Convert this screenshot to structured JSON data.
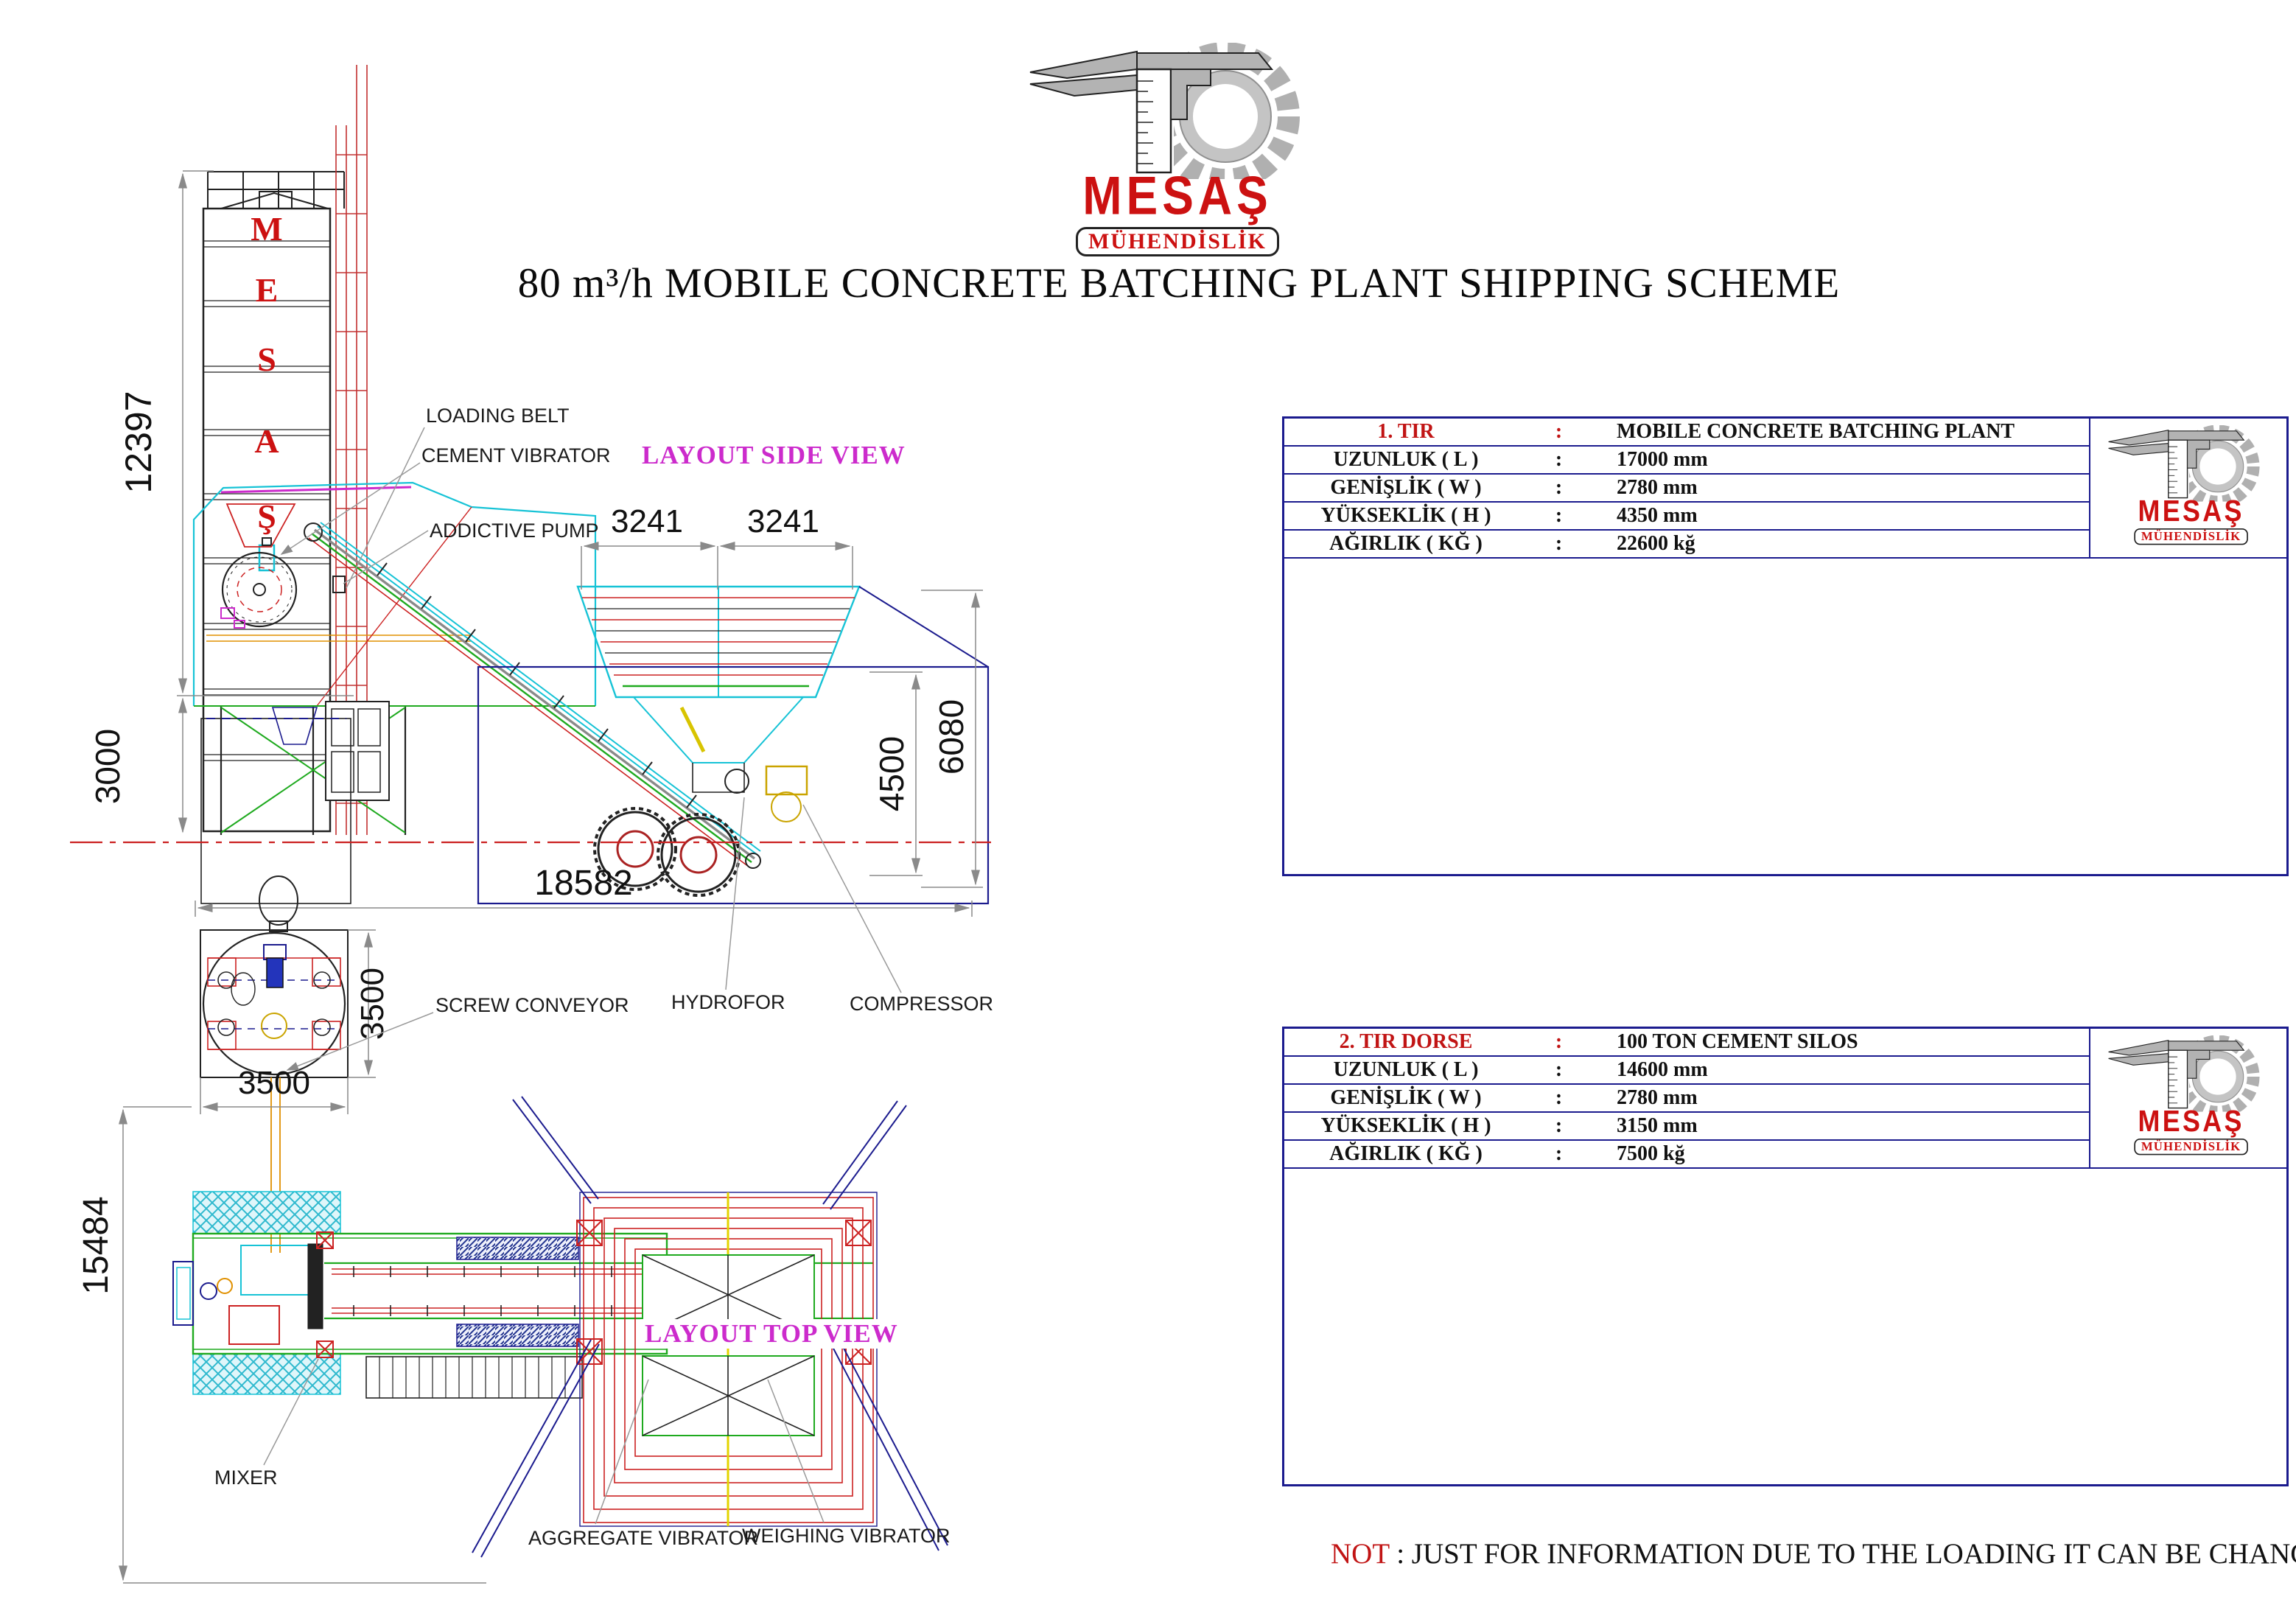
{
  "logo": {
    "brand": "MESAŞ",
    "sub": "MÜHENDİSLİK"
  },
  "title": "80 m³/h MOBILE CONCRETE BATCHING PLANT SHIPPING SCHEME",
  "side_view": {
    "label": "LAYOUT SIDE VIEW",
    "silo_letters": [
      "M",
      "E",
      "S",
      "A",
      "Ş"
    ],
    "callouts": {
      "loading_belt": "LOADING BELT",
      "cement_vibrator": "CEMENT VIBRATOR",
      "addictive_pump": "ADDICTIVE PUMP"
    },
    "dims": {
      "total_height": "12397",
      "foundation_height": "3000",
      "base_length": "18582",
      "bin_left": "3241",
      "bin_right": "3241",
      "hopper_height": "4500",
      "overall_height": "6080"
    }
  },
  "top_view": {
    "label": "LAYOUT TOP VIEW",
    "callouts": {
      "screw_conveyor": "SCREW CONVEYOR",
      "hydrofor": "HYDROFOR",
      "compressor": "COMPRESSOR",
      "mixer": "MIXER",
      "aggregate_vibrator": "AGGREGATE VIBRATOR",
      "weighing_vibrator": "WEIGHING VIBRATOR"
    },
    "dims": {
      "silo_width": "3500",
      "silo_height": "3500",
      "yard_height": "15484"
    }
  },
  "panel1": {
    "rows": [
      {
        "key": "1. TIR",
        "sep": ":",
        "value": "MOBILE CONCRETE BATCHING PLANT"
      },
      {
        "key": "UZUNLUK ( L )",
        "sep": ":",
        "value": "17000 mm"
      },
      {
        "key": "GENİŞLİK ( W )",
        "sep": ":",
        "value": "2780 mm"
      },
      {
        "key": "YÜKSEKLİK ( H )",
        "sep": ":",
        "value": "4350 mm"
      },
      {
        "key": "AĞIRLIK ( KĞ )",
        "sep": ":",
        "value": "22600 kğ"
      }
    ],
    "dims": {
      "height": "4350",
      "chassis": "CHASSIS LENGH 15000 mm",
      "total": "TOTAL LENGH 17000 mm"
    }
  },
  "panel2": {
    "rows": [
      {
        "key": "2. TIR DORSE",
        "sep": ":",
        "value": "100 TON CEMENT SILOS"
      },
      {
        "key": "UZUNLUK ( L )",
        "sep": ":",
        "value": "14600 mm"
      },
      {
        "key": "GENİŞLİK ( W )",
        "sep": ":",
        "value": "2780 mm"
      },
      {
        "key": "YÜKSEKLİK ( H )",
        "sep": ":",
        "value": "3150 mm"
      },
      {
        "key": "AĞIRLIK ( KĞ )",
        "sep": ":",
        "value": "7500 kğ"
      }
    ],
    "dims": {
      "height": "3150",
      "length": "14600",
      "rear_width": "3150"
    },
    "trailer_brand": "MESAŞ MÜHENDİSLİK"
  },
  "note": {
    "prefix": "NOT",
    "text": " : JUST FOR INFORMATION DUE TO THE LOADING IT CAN BE CHANGE."
  },
  "colors": {
    "brand_red": "#cc1111",
    "layout_magenta": "#cc2bcc",
    "table_navy": "#1b1b8e",
    "ground_red": "#cc2222",
    "dim_gray": "#8a8a8a"
  }
}
